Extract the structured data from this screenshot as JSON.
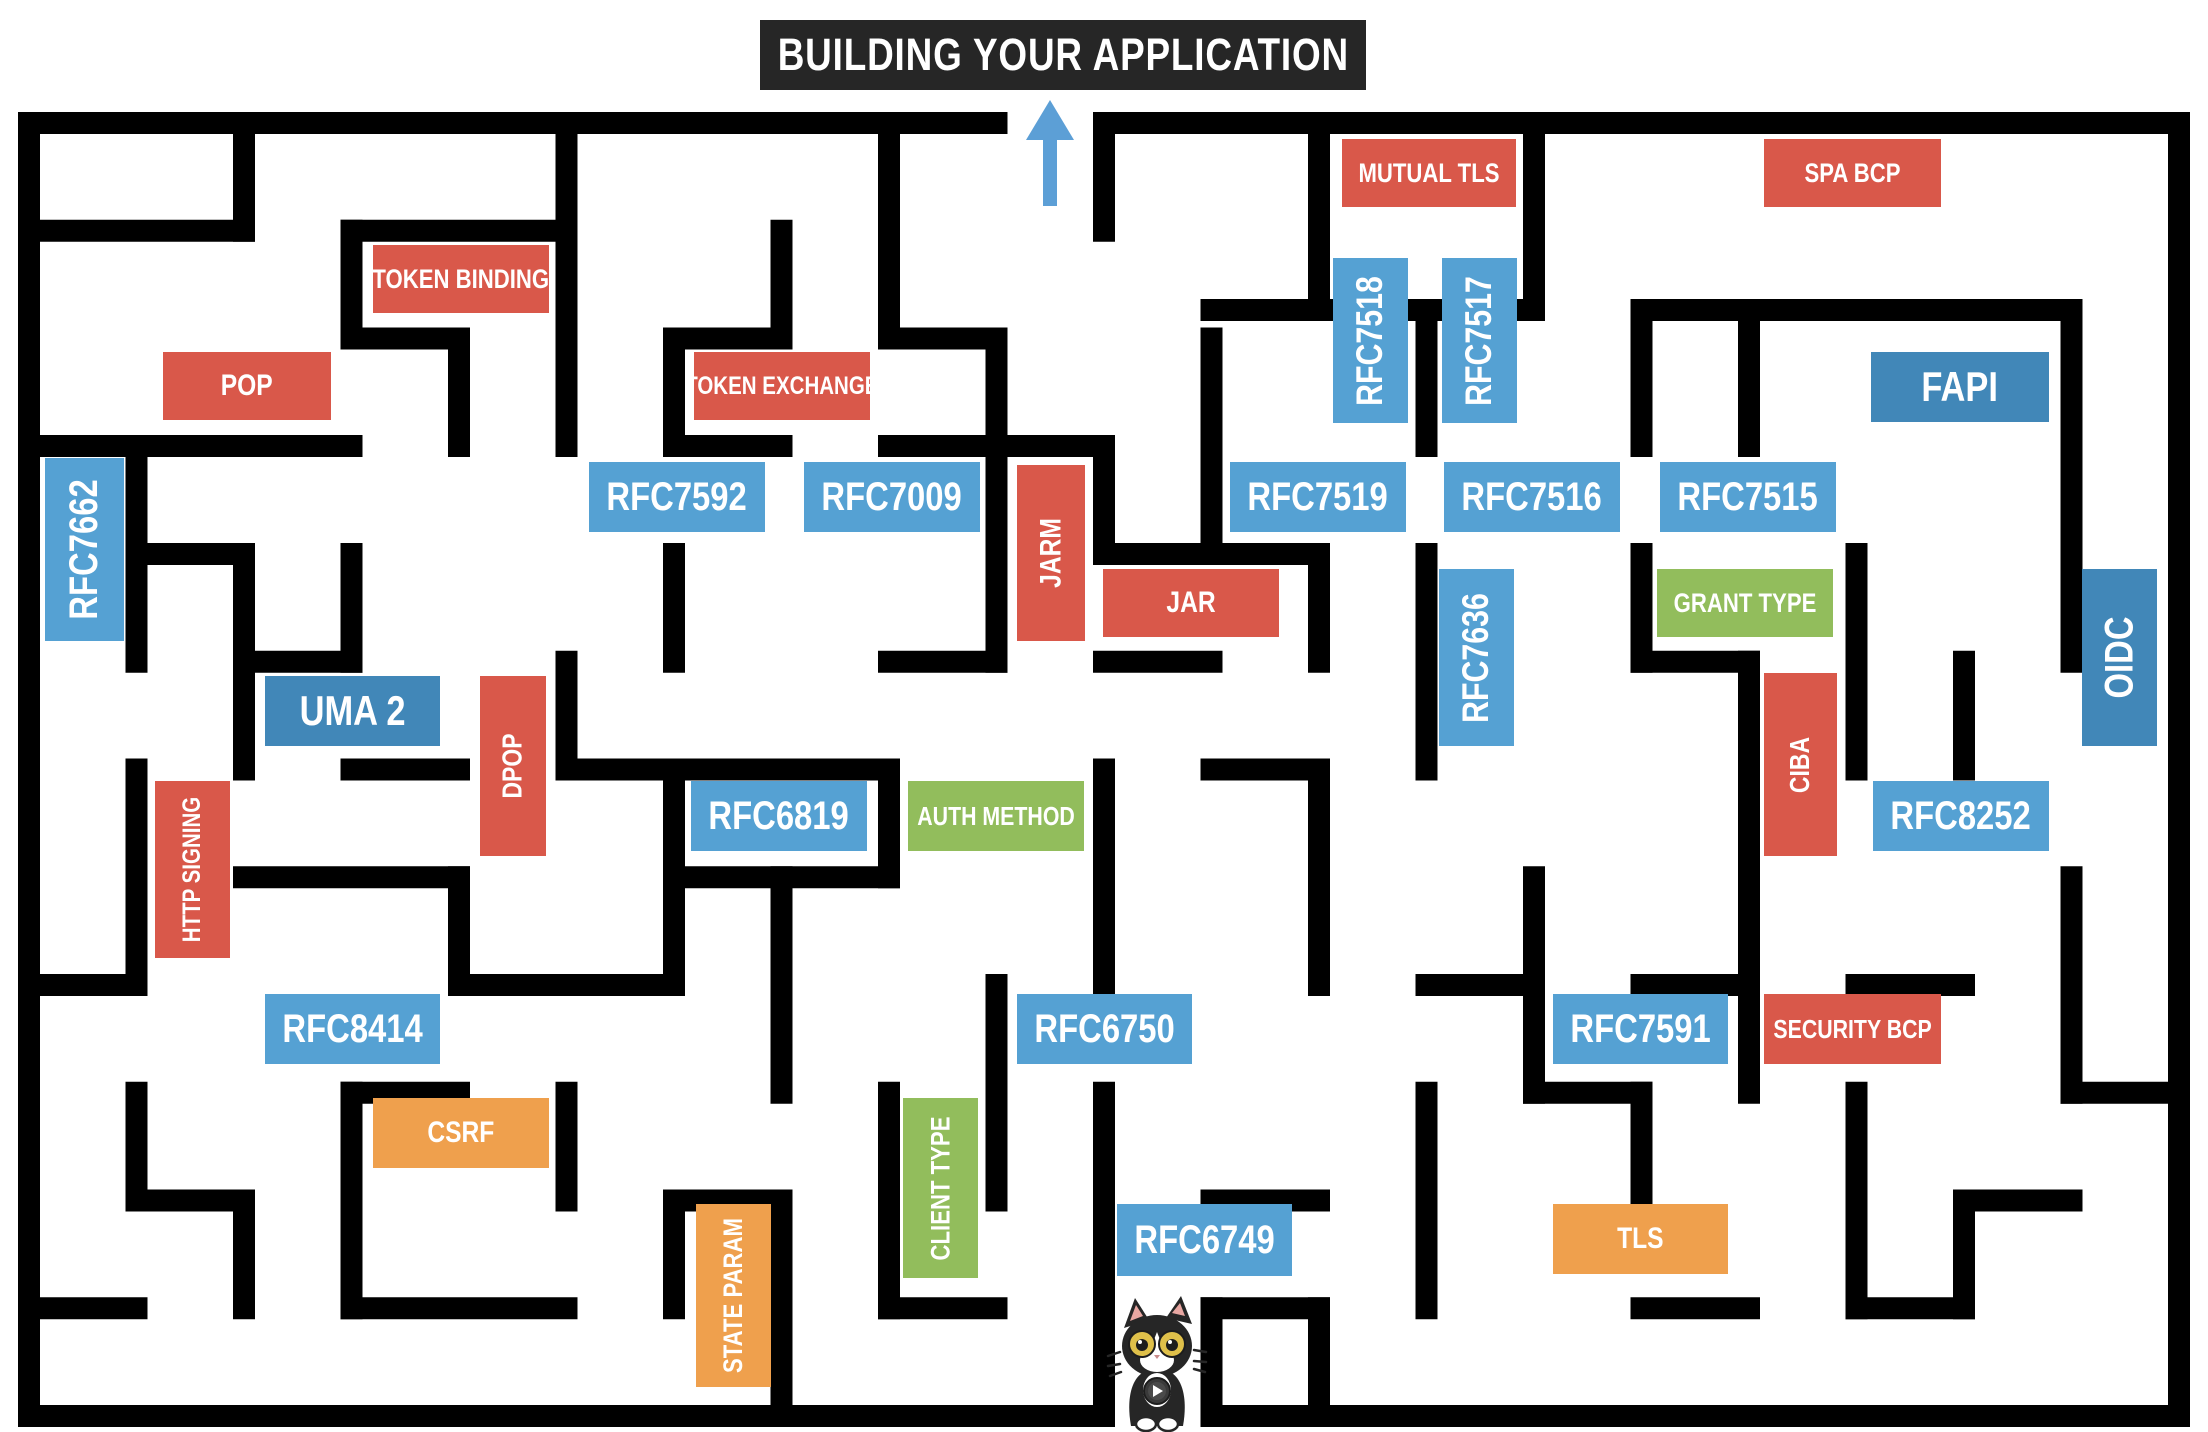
{
  "title": {
    "text": "BUILDING YOUR APPLICATION"
  },
  "colors": {
    "wall": "#000000",
    "title_bg": "#262626",
    "arrow": "#5C9FD6",
    "red": "#D9584A",
    "blue": "#55A1D3",
    "darkblue": "#4187B8",
    "green": "#92BD5C",
    "orange": "#EFA04D",
    "cat_black": "#262626",
    "cat_eye": "#DFC04A",
    "cat_ear": "#E8A7A2"
  },
  "legend_semantics": {
    "red": "security-technique",
    "blue": "rfc-spec",
    "darkblue": "framework",
    "green": "concept",
    "orange": "mitigation"
  },
  "labels": [
    {
      "id": "token-binding",
      "text": "TOKEN BINDING",
      "x": 373,
      "y": 245,
      "w": 176,
      "h": 68,
      "color": "red",
      "orient": "h",
      "fs": 27
    },
    {
      "id": "pop",
      "text": "POP",
      "x": 163,
      "y": 352,
      "w": 168,
      "h": 68,
      "color": "red",
      "orient": "h",
      "fs": 30
    },
    {
      "id": "token-exchange",
      "text": "TOKEN EXCHANGE",
      "x": 694,
      "y": 352,
      "w": 176,
      "h": 68,
      "color": "red",
      "orient": "h",
      "fs": 25
    },
    {
      "id": "mutual-tls",
      "text": "MUTUAL TLS",
      "x": 1342,
      "y": 139,
      "w": 174,
      "h": 68,
      "color": "red",
      "orient": "h",
      "fs": 27
    },
    {
      "id": "spa-bcp",
      "text": "SPA BCP",
      "x": 1764,
      "y": 139,
      "w": 177,
      "h": 68,
      "color": "red",
      "orient": "h",
      "fs": 27
    },
    {
      "id": "rfc7662",
      "text": "RFC7662",
      "x": 45,
      "y": 458,
      "w": 79,
      "h": 183,
      "color": "blue",
      "orient": "v",
      "fs": 40
    },
    {
      "id": "rfc7592",
      "text": "RFC7592",
      "x": 589,
      "y": 462,
      "w": 176,
      "h": 70,
      "color": "blue",
      "orient": "h",
      "fs": 40
    },
    {
      "id": "rfc7009",
      "text": "RFC7009",
      "x": 804,
      "y": 462,
      "w": 176,
      "h": 70,
      "color": "blue",
      "orient": "h",
      "fs": 40
    },
    {
      "id": "rfc7518",
      "text": "RFC7518",
      "x": 1333,
      "y": 258,
      "w": 75,
      "h": 165,
      "color": "blue",
      "orient": "v",
      "fs": 37
    },
    {
      "id": "rfc7517",
      "text": "RFC7517",
      "x": 1442,
      "y": 258,
      "w": 75,
      "h": 165,
      "color": "blue",
      "orient": "v",
      "fs": 37
    },
    {
      "id": "rfc7519",
      "text": "RFC7519",
      "x": 1230,
      "y": 462,
      "w": 176,
      "h": 70,
      "color": "blue",
      "orient": "h",
      "fs": 40
    },
    {
      "id": "rfc7516",
      "text": "RFC7516",
      "x": 1444,
      "y": 462,
      "w": 176,
      "h": 70,
      "color": "blue",
      "orient": "h",
      "fs": 40
    },
    {
      "id": "rfc7515",
      "text": "RFC7515",
      "x": 1660,
      "y": 462,
      "w": 176,
      "h": 70,
      "color": "blue",
      "orient": "h",
      "fs": 40
    },
    {
      "id": "fapi",
      "text": "FAPI",
      "x": 1871,
      "y": 352,
      "w": 178,
      "h": 70,
      "color": "darkblue",
      "orient": "h",
      "fs": 42
    },
    {
      "id": "oidc",
      "text": "OIDC",
      "x": 2082,
      "y": 569,
      "w": 75,
      "h": 177,
      "color": "darkblue",
      "orient": "v",
      "fs": 40
    },
    {
      "id": "jarm",
      "text": "JARM",
      "x": 1017,
      "y": 465,
      "w": 68,
      "h": 176,
      "color": "red",
      "orient": "v",
      "fs": 30
    },
    {
      "id": "jar",
      "text": "JAR",
      "x": 1103,
      "y": 569,
      "w": 176,
      "h": 68,
      "color": "red",
      "orient": "h",
      "fs": 30
    },
    {
      "id": "rfc7636",
      "text": "RFC7636",
      "x": 1439,
      "y": 569,
      "w": 75,
      "h": 177,
      "color": "blue",
      "orient": "v",
      "fs": 37
    },
    {
      "id": "grant-type",
      "text": "GRANT TYPE",
      "x": 1657,
      "y": 569,
      "w": 176,
      "h": 68,
      "color": "green",
      "orient": "h",
      "fs": 27
    },
    {
      "id": "uma2",
      "text": "UMA 2",
      "x": 265,
      "y": 676,
      "w": 175,
      "h": 70,
      "color": "darkblue",
      "orient": "h",
      "fs": 42
    },
    {
      "id": "dpop",
      "text": "DPOP",
      "x": 480,
      "y": 676,
      "w": 66,
      "h": 180,
      "color": "red",
      "orient": "v",
      "fs": 28
    },
    {
      "id": "ciba",
      "text": "CIBA",
      "x": 1764,
      "y": 673,
      "w": 73,
      "h": 183,
      "color": "red",
      "orient": "v",
      "fs": 28
    },
    {
      "id": "rfc6819",
      "text": "RFC6819",
      "x": 691,
      "y": 781,
      "w": 176,
      "h": 70,
      "color": "blue",
      "orient": "h",
      "fs": 40
    },
    {
      "id": "auth-method",
      "text": "AUTH METHOD",
      "x": 908,
      "y": 781,
      "w": 176,
      "h": 70,
      "color": "green",
      "orient": "h",
      "fs": 26
    },
    {
      "id": "rfc8252",
      "text": "RFC8252",
      "x": 1873,
      "y": 781,
      "w": 176,
      "h": 70,
      "color": "blue",
      "orient": "h",
      "fs": 40
    },
    {
      "id": "http-signing",
      "text": "HTTP SIGNING",
      "x": 155,
      "y": 781,
      "w": 75,
      "h": 177,
      "color": "red",
      "orient": "v",
      "fs": 25
    },
    {
      "id": "rfc8414",
      "text": "RFC8414",
      "x": 265,
      "y": 994,
      "w": 175,
      "h": 70,
      "color": "blue",
      "orient": "h",
      "fs": 40
    },
    {
      "id": "rfc6750",
      "text": "RFC6750",
      "x": 1017,
      "y": 994,
      "w": 175,
      "h": 70,
      "color": "blue",
      "orient": "h",
      "fs": 40
    },
    {
      "id": "rfc7591",
      "text": "RFC7591",
      "x": 1553,
      "y": 994,
      "w": 175,
      "h": 70,
      "color": "blue",
      "orient": "h",
      "fs": 40
    },
    {
      "id": "security-bcp",
      "text": "SECURITY BCP",
      "x": 1764,
      "y": 994,
      "w": 177,
      "h": 70,
      "color": "red",
      "orient": "h",
      "fs": 26
    },
    {
      "id": "csrf",
      "text": "CSRF",
      "x": 373,
      "y": 1098,
      "w": 176,
      "h": 70,
      "color": "orange",
      "orient": "h",
      "fs": 30
    },
    {
      "id": "client-type",
      "text": "CLIENT TYPE",
      "x": 903,
      "y": 1098,
      "w": 75,
      "h": 180,
      "color": "green",
      "orient": "v",
      "fs": 27
    },
    {
      "id": "rfc6749",
      "text": "RFC6749",
      "x": 1117,
      "y": 1204,
      "w": 175,
      "h": 72,
      "color": "blue",
      "orient": "h",
      "fs": 40
    },
    {
      "id": "tls",
      "text": "TLS",
      "x": 1553,
      "y": 1204,
      "w": 175,
      "h": 70,
      "color": "orange",
      "orient": "h",
      "fs": 30
    },
    {
      "id": "state-param",
      "text": "STATE PARAM",
      "x": 696,
      "y": 1204,
      "w": 75,
      "h": 183,
      "color": "orange",
      "orient": "v",
      "fs": 27
    }
  ],
  "maze": {
    "width": 2208,
    "height": 1432,
    "wall_thickness": 22,
    "exit_opening": {
      "side": "top",
      "x1": 996,
      "x2": 1104
    },
    "entrance_opening": {
      "side": "bottom",
      "x1": 1104,
      "x2": 1212
    },
    "h_walls": [
      [
        29,
        123,
        996.5
      ],
      [
        1104,
        123,
        2179
      ],
      [
        29,
        1416,
        1104
      ],
      [
        1211.5,
        1416,
        2179
      ],
      [
        29,
        230.75,
        244
      ],
      [
        351.5,
        230.75,
        566.5
      ],
      [
        351.5,
        338.5,
        459
      ],
      [
        674,
        338.5,
        781.5
      ],
      [
        889,
        338.5,
        996.5
      ],
      [
        29,
        446,
        351.5
      ],
      [
        674,
        446,
        781.5
      ],
      [
        889,
        446,
        996.5
      ],
      [
        996.5,
        446,
        1104
      ],
      [
        1211.5,
        310,
        1534
      ],
      [
        1641.5,
        310,
        2071.5
      ],
      [
        1104,
        554,
        1319
      ],
      [
        136.5,
        554,
        244
      ],
      [
        889,
        661.75,
        996.5
      ],
      [
        1104,
        661.75,
        1211.5
      ],
      [
        244,
        661.75,
        351.5
      ],
      [
        1641.5,
        661.75,
        1749
      ],
      [
        351.5,
        769.5,
        459
      ],
      [
        566.5,
        769.5,
        889
      ],
      [
        1211.5,
        769.5,
        1319
      ],
      [
        244,
        877.25,
        459
      ],
      [
        674,
        877.25,
        889
      ],
      [
        29,
        985,
        136.5
      ],
      [
        459,
        985,
        674
      ],
      [
        1426.5,
        985,
        1534
      ],
      [
        1641.5,
        985,
        1749
      ],
      [
        1856.5,
        985,
        1964
      ],
      [
        351.5,
        1092.75,
        459
      ],
      [
        1534,
        1092.75,
        1641.5
      ],
      [
        2071.5,
        1092.75,
        2179
      ],
      [
        136.5,
        1200.5,
        244
      ],
      [
        674,
        1200.5,
        781.5
      ],
      [
        1211.5,
        1200.5,
        1319
      ],
      [
        1964,
        1200.5,
        2071.5
      ],
      [
        29,
        1308.25,
        136.5
      ],
      [
        351.5,
        1308.25,
        566.5
      ],
      [
        889,
        1308.25,
        996.5
      ],
      [
        1211.5,
        1308.25,
        1319
      ],
      [
        1641.5,
        1308.25,
        1749
      ],
      [
        1856.5,
        1308.25,
        1964
      ]
    ],
    "v_walls": [
      [
        29,
        123,
        1416
      ],
      [
        2179,
        123,
        1416
      ],
      [
        244,
        123,
        230.75
      ],
      [
        566.5,
        123,
        446
      ],
      [
        889,
        123,
        338.5
      ],
      [
        1104,
        123,
        230.75
      ],
      [
        1319,
        123,
        310
      ],
      [
        1534,
        123,
        310
      ],
      [
        351.5,
        230.75,
        338.5
      ],
      [
        781.5,
        230.75,
        338.5
      ],
      [
        2071.5,
        310,
        661.75
      ],
      [
        1749,
        310,
        446
      ],
      [
        1641.5,
        310,
        446
      ],
      [
        1426.5,
        310,
        446
      ],
      [
        136.5,
        446,
        661.75
      ],
      [
        459,
        338.5,
        446
      ],
      [
        674,
        338.5,
        446
      ],
      [
        996.5,
        338.5,
        661.75
      ],
      [
        1211.5,
        338.5,
        554
      ],
      [
        1104,
        446,
        554
      ],
      [
        1319,
        554,
        661.75
      ],
      [
        1426.5,
        554,
        769.5
      ],
      [
        1641.5,
        554,
        661.75
      ],
      [
        1856.5,
        554,
        661.75
      ],
      [
        351.5,
        554,
        661.75
      ],
      [
        244,
        554,
        769.5
      ],
      [
        674,
        554,
        661.75
      ],
      [
        566.5,
        661.75,
        769.5
      ],
      [
        1749,
        661.75,
        877.25
      ],
      [
        1856.5,
        661.75,
        769.5
      ],
      [
        1964,
        661.75,
        769.5
      ],
      [
        136.5,
        769.5,
        985
      ],
      [
        674,
        769.5,
        985
      ],
      [
        889,
        769.5,
        877.25
      ],
      [
        1104,
        769.5,
        985
      ],
      [
        1319,
        769.5,
        985
      ],
      [
        459,
        877.25,
        985
      ],
      [
        781.5,
        877.25,
        1092.75
      ],
      [
        1534,
        877.25,
        1092.75
      ],
      [
        1749,
        877.25,
        1092.75
      ],
      [
        2071.5,
        877.25,
        1092.75
      ],
      [
        136.5,
        1092.75,
        1200.5
      ],
      [
        351.5,
        1092.75,
        1308.25
      ],
      [
        566.5,
        1092.75,
        1200.5
      ],
      [
        889,
        1092.75,
        1308.25
      ],
      [
        996.5,
        985,
        1200.5
      ],
      [
        1104,
        1092.75,
        1416
      ],
      [
        1426.5,
        1092.75,
        1308.25
      ],
      [
        1641.5,
        1092.75,
        1200.5
      ],
      [
        1856.5,
        1092.75,
        1308.25
      ],
      [
        244,
        1200.5,
        1308.25
      ],
      [
        781.5,
        1200.5,
        1416
      ],
      [
        674,
        1200.5,
        1308.25
      ],
      [
        1211.5,
        1308.25,
        1416
      ],
      [
        1319,
        1308.25,
        1416
      ],
      [
        1964,
        1200.5,
        1308.25
      ]
    ]
  },
  "arrow": {
    "x": 1050,
    "tip_y": 100,
    "tail_y": 206,
    "head_w": 48,
    "head_h": 40,
    "shaft_w": 14
  },
  "cat": {
    "x": 1106,
    "y": 1294,
    "w": 102,
    "h": 138,
    "description": "tuxedo cat mascot with yellow eyes and medal"
  }
}
